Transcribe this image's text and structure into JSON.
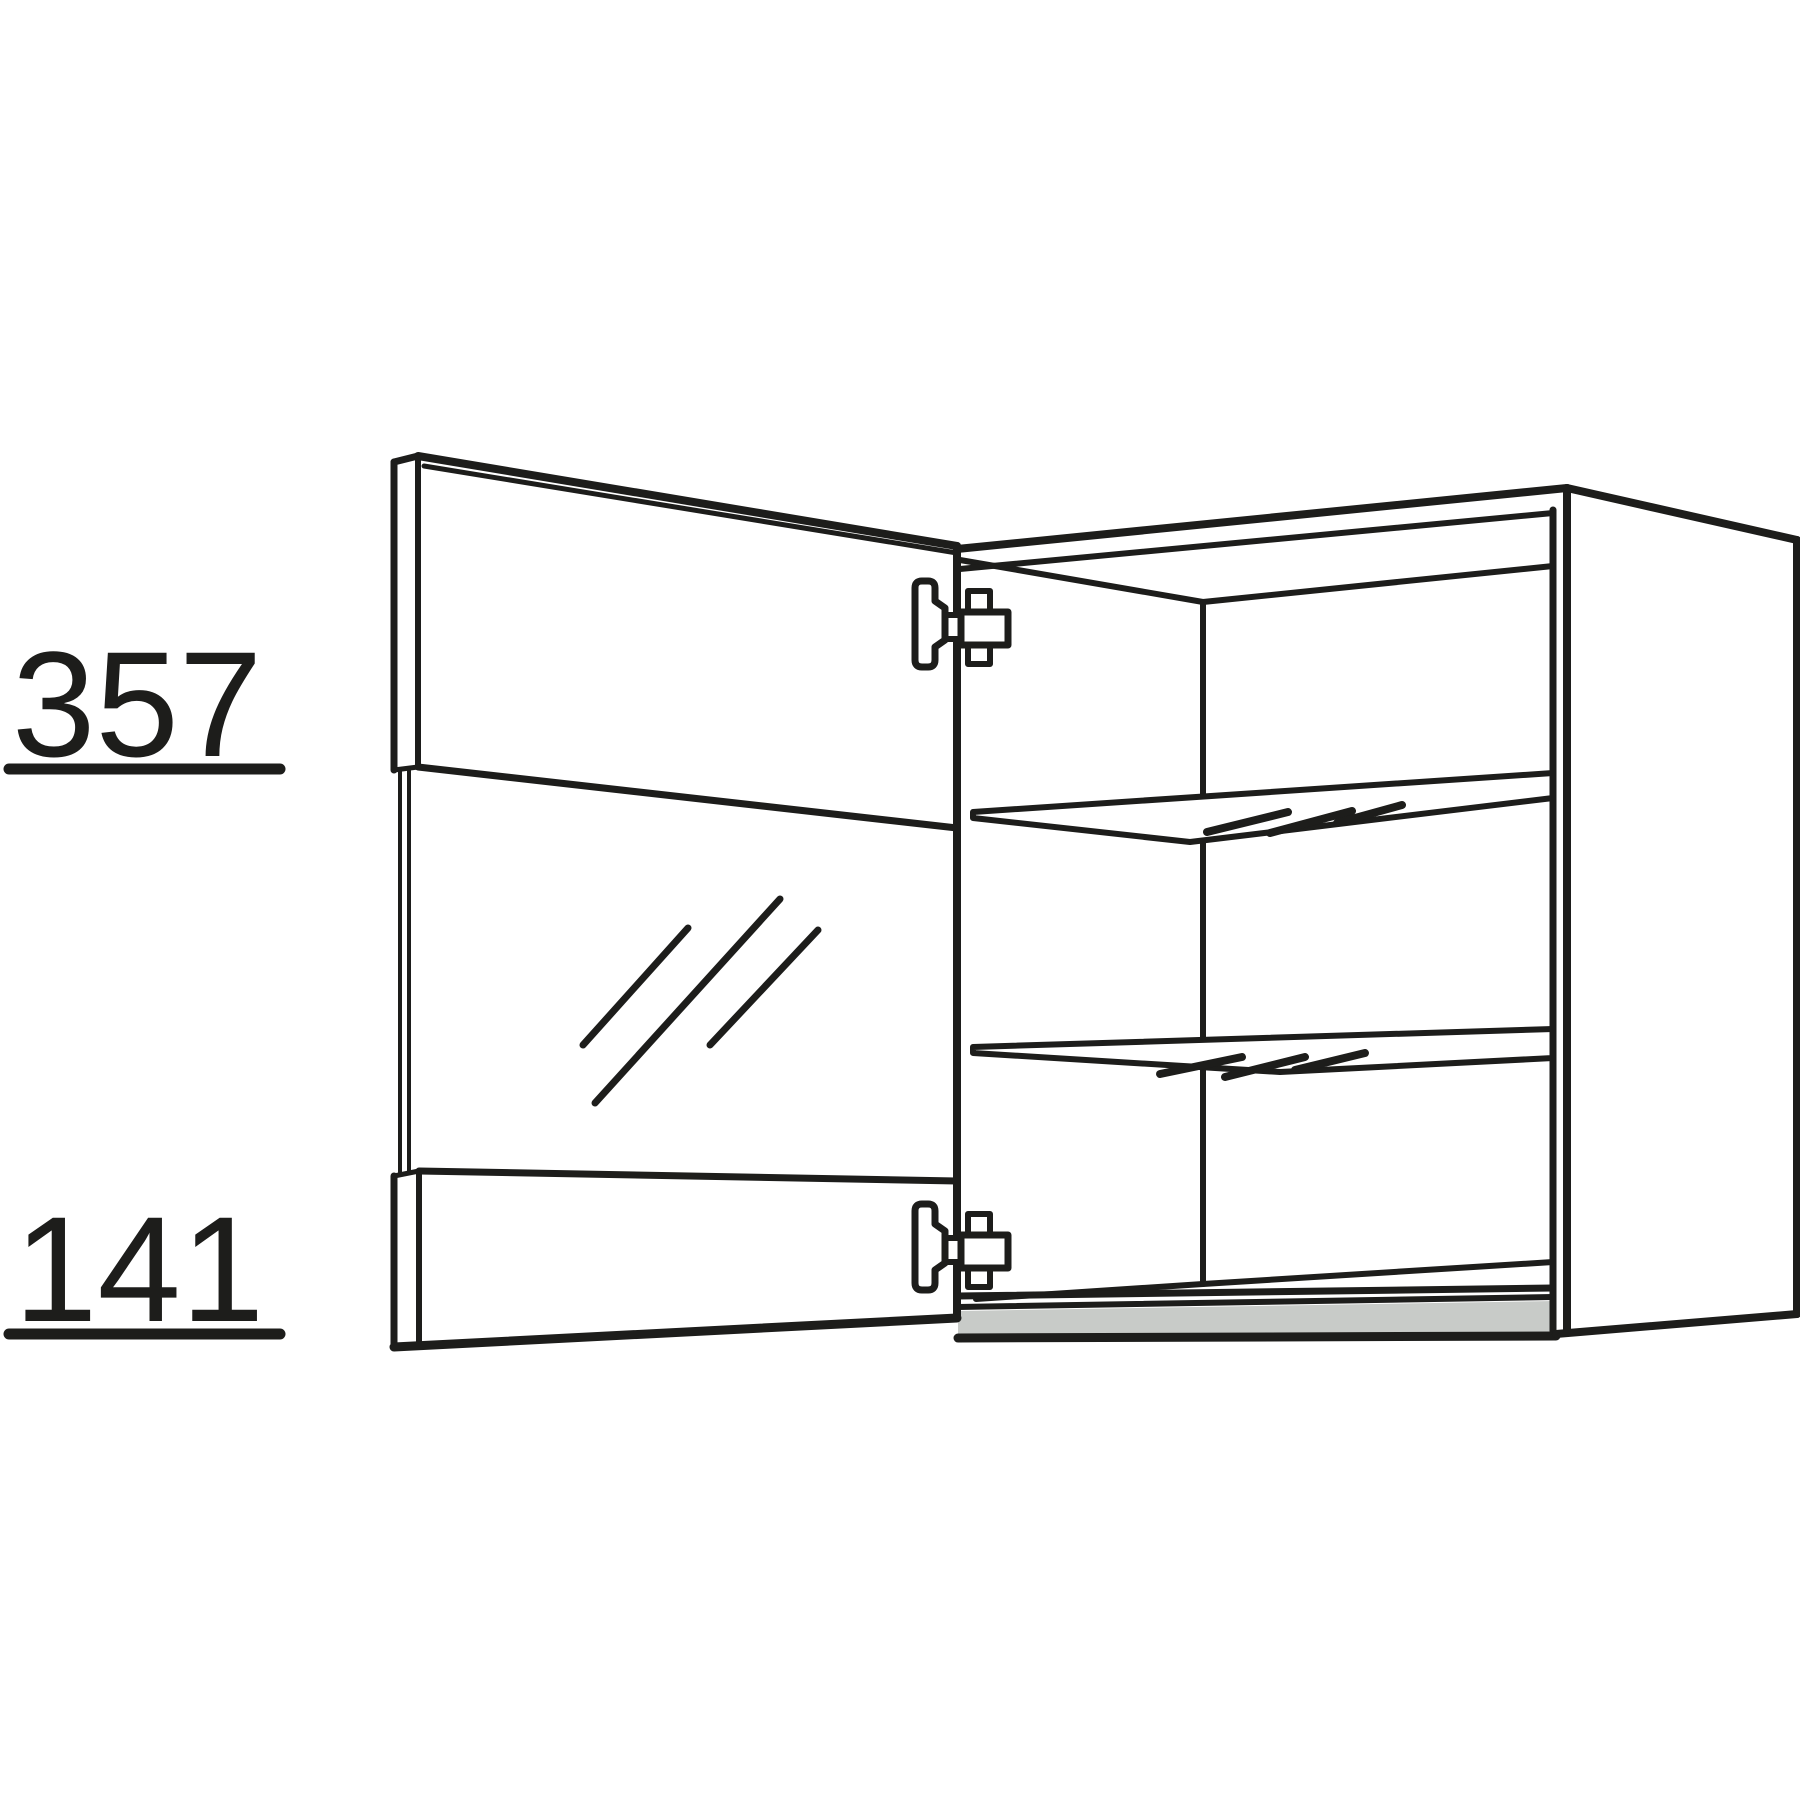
{
  "drawing": {
    "colors": {
      "line": "#1d1d1b",
      "bottom_panel_front_gray": "#c8cbc8",
      "background": "#ffffff"
    },
    "dimensions": {
      "upper": {
        "label": "357"
      },
      "lower": {
        "label": "141"
      }
    },
    "parts": {
      "door": "glass-framed-door-open",
      "carcass": "wall-cabinet-carcass",
      "shelves": "two-glass-shelves",
      "hinges": "two-concealed-hinges"
    }
  }
}
